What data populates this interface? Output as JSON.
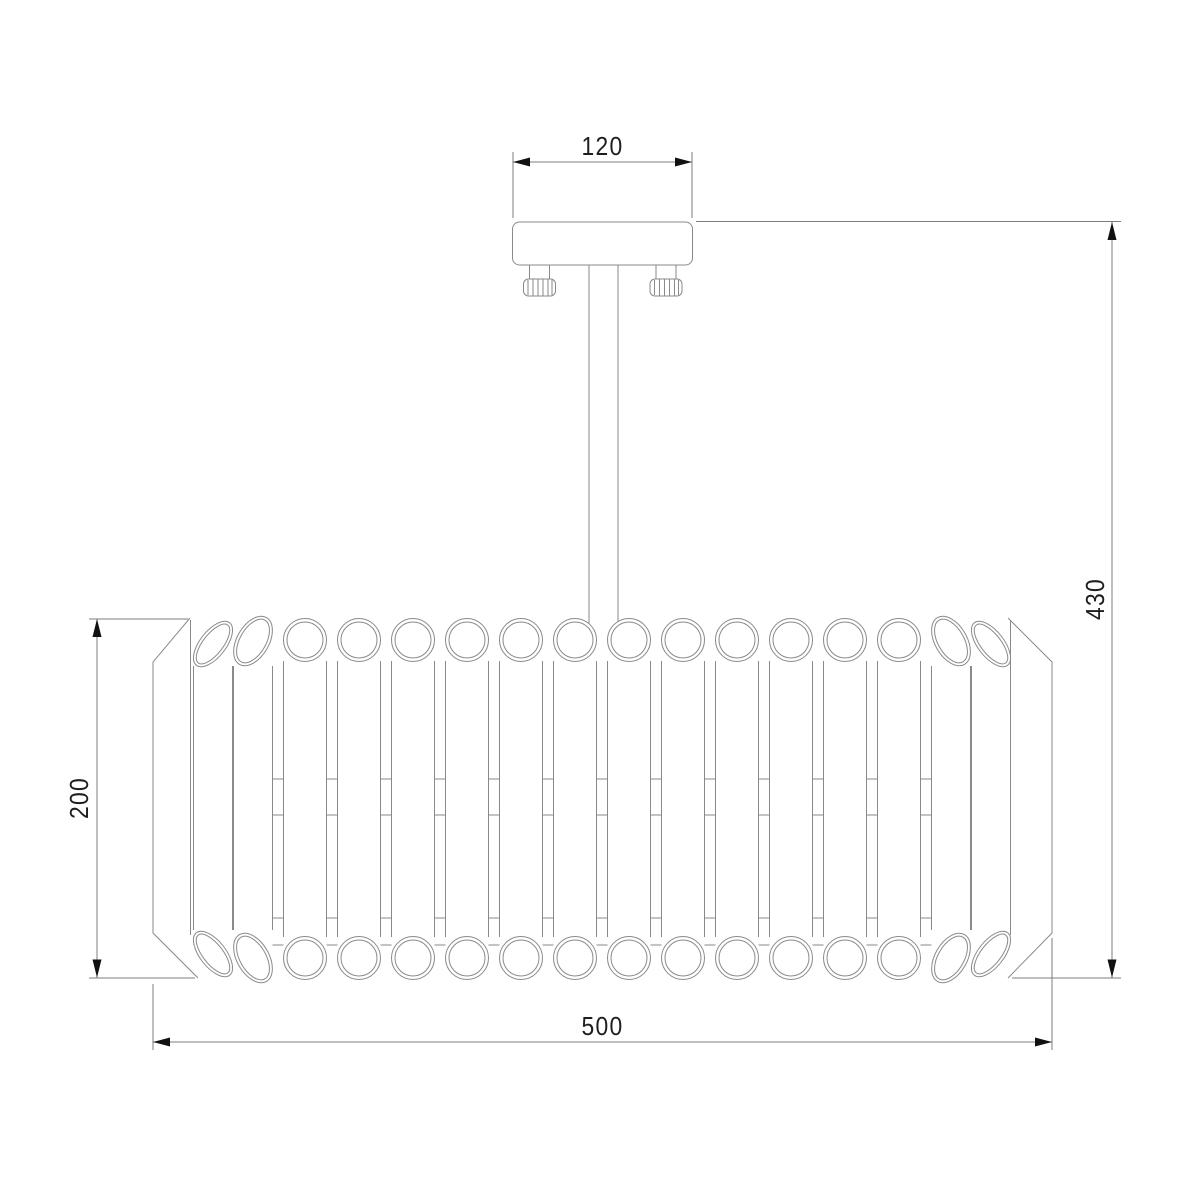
{
  "dimensions": {
    "canopy_width": "120",
    "fixture_height": "430",
    "shade_height": "200",
    "shade_width": "500"
  },
  "colors": {
    "line": "#8a8a8a",
    "dim": "#7d7d7d",
    "text": "#1e1e1e",
    "arrow": "#111111",
    "background": "#ffffff"
  }
}
